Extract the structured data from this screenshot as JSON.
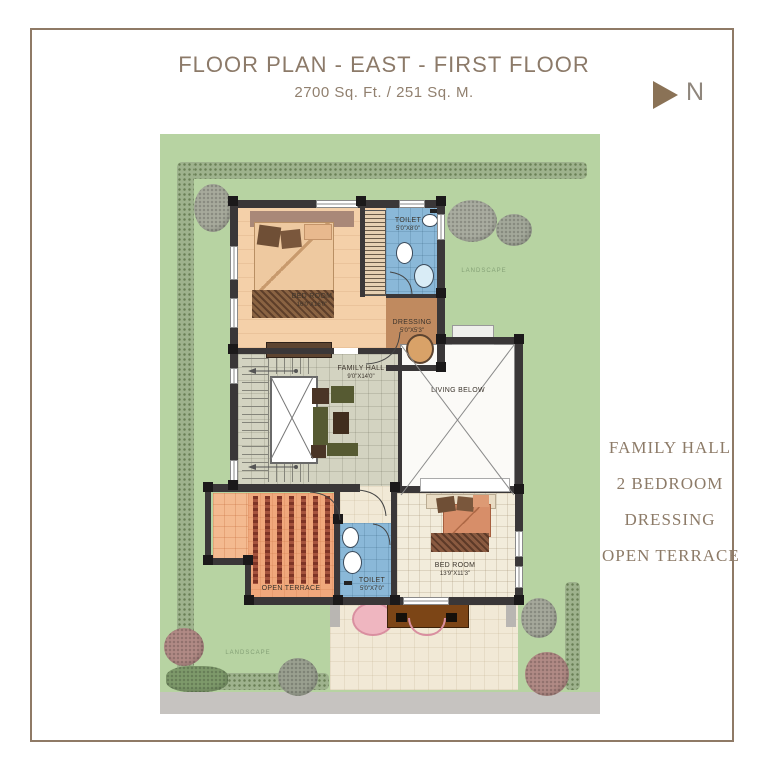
{
  "header": {
    "title": "FLOOR PLAN - EAST - FIRST FLOOR",
    "subtitle": "2700 Sq. Ft. / 251 Sq. M.",
    "north_label": "N"
  },
  "rooms": {
    "bedroom1": {
      "name": "BED ROOM",
      "dims": "16'0\"X16'0\""
    },
    "toilet1": {
      "name": "TOILET",
      "dims": "5'0\"X8'0\""
    },
    "dressing": {
      "name": "DRESSING",
      "dims": "5'0\"X5'3\""
    },
    "family_hall": {
      "name": "FAMILY HALL",
      "dims": "9'0\"X14'0\""
    },
    "living_below": {
      "name": "LIVING BELOW"
    },
    "open_terrace": {
      "name": "OPEN TERRACE"
    },
    "toilet2": {
      "name": "TOILET",
      "dims": "5'0\"X7'0\""
    },
    "bedroom2": {
      "name": "BED ROOM",
      "dims": "13'9\"X11'3\""
    }
  },
  "site": {
    "landscape_label_1": "LANDSCAPE",
    "landscape_label_2": "LANDSCAPE"
  },
  "legend": {
    "items": [
      "FAMILY HALL",
      "2 BEDROOM",
      "DRESSING",
      "OPEN TERRACE"
    ]
  },
  "colors": {
    "accent_brown": "#8c7a69",
    "frame_border": "#8f7a66",
    "lawn_green": "#b7d3a2",
    "wall_dark": "#3a3738",
    "toilet_blue": "#8ab8d8",
    "terrace_orange": "#f0a87c",
    "hall_sage": "#d3d3c1",
    "bedroom1_peach": "#f4d0a9",
    "bedroom2_cream": "#f2ecdb",
    "road_gray": "#c6c3c0"
  }
}
